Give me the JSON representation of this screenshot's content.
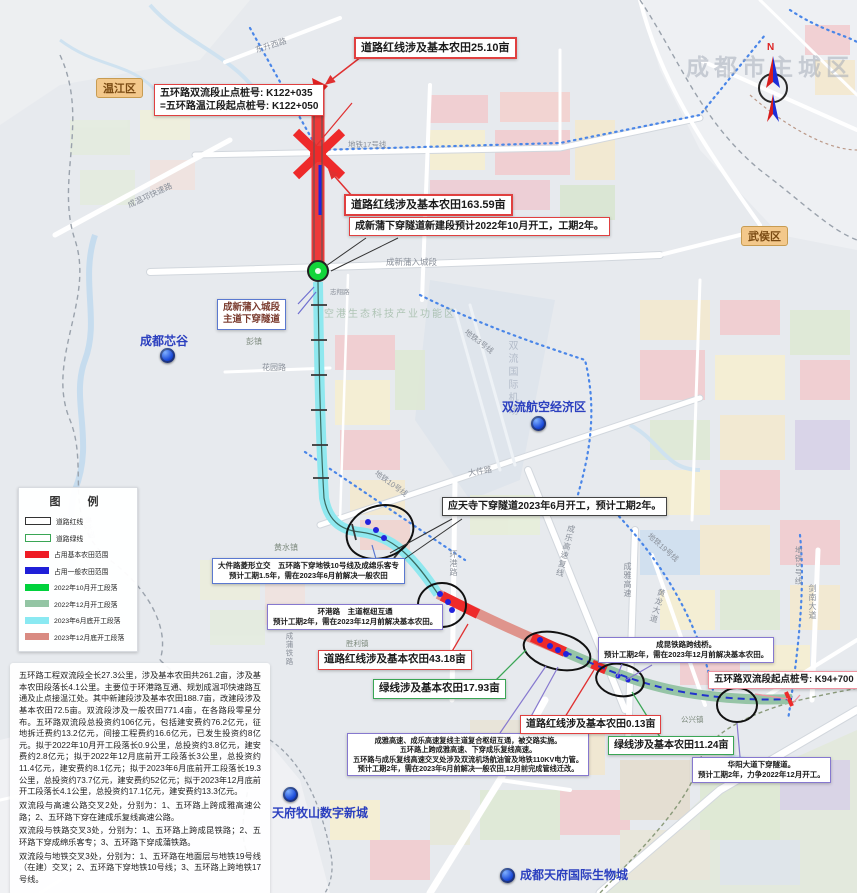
{
  "watermark": "成都市主城区",
  "districts": {
    "wenjiang": "温江区",
    "wuhou": "武侯区"
  },
  "compass": {
    "north": "N"
  },
  "legend": {
    "title": "图　例",
    "items": [
      {
        "label": "道路红线",
        "swatch": "outline-black"
      },
      {
        "label": "道路绿线",
        "swatch": "outline-green"
      },
      {
        "label": "占用基本农田范围",
        "color": "#ee1c25"
      },
      {
        "label": "占用一般农田范围",
        "color": "#1f1fd8"
      },
      {
        "label": "2022年10月开工段落",
        "color": "#00d23c"
      },
      {
        "label": "2022年12月开工段落",
        "color": "#93c5a4"
      },
      {
        "label": "2023年6月底开工段落",
        "color": "#8ae9f2"
      },
      {
        "label": "2023年12月底开工段落",
        "color": "#d98b82"
      }
    ]
  },
  "callouts": {
    "endpoint_stake": {
      "line1": "五环路双流段止点桩号: K122+035",
      "line2": "=五环路温江段起点桩号: K122+050"
    },
    "redline_2510": {
      "text": "道路红线涉及基本农田25.10亩"
    },
    "redline_16359": {
      "text": "道路红线涉及基本农田163.59亩"
    },
    "chengxinpu_tunnel": {
      "text": "成新蒲下穿隧道新建段预计2022年10月开工，工期2年。"
    },
    "chengxinpu_entry": {
      "line1": "成新蒲入城段",
      "line2": "主道下穿隧道"
    },
    "yingtiansi": {
      "text": "应天寺下穿隧道2023年6月开工，预计工期2年。"
    },
    "dajianlu": {
      "line1": "大件路菱形立交　五环路下穿地铁10号线及成绵乐客专",
      "line2": "预计工期1.5年，需在2023年6月前解决一般农田"
    },
    "huanganglu": {
      "line1": "环港路　主道枢纽互通",
      "line2": "预计工期2年，需在2023年12月前解决基本农田。"
    },
    "redline_4318": {
      "text": "道路红线涉及基本农田43.18亩"
    },
    "greenline_1793": {
      "text": "绿线涉及基本农田17.93亩"
    },
    "hub": {
      "line1": "成雅高速、成乐高速复线主道复合枢纽互通，被交路实施。",
      "line2": "五环路上跨成雅高速、下穿成乐复线高速。",
      "line3": "五环路与成乐复线高速交叉处涉及双流机场航油管及地铁110KV电力管。",
      "line4": "预计工期2年，需在2023年6月前解决一般农田,12月前完成管线迁改。"
    },
    "redline_013": {
      "text": "道路红线涉及基本农田0.13亩"
    },
    "greenline_1124": {
      "text": "绿线涉及基本农田11.24亩"
    },
    "chengkun_bridge": {
      "line1": "成昆铁路跨线桥。",
      "line2": "预计工期2年，需在2023年12月前解决基本农田。"
    },
    "start_stake": {
      "text": "五环路双流段起点桩号: K94+700"
    },
    "huayang_tunnel": {
      "line1": "华阳大道下穿隧道。",
      "line2": "预计工期2年，力争2022年12月开工。"
    }
  },
  "labels": {
    "dongsheng_xilu": "东升西路",
    "metro17": "地铁17号线",
    "chengwenqiong": "成温邛快速路",
    "chengxinpu_rd": "成新蒲入城段",
    "zhixiang_rd": "志翔路",
    "pengzhen": "彭镇",
    "huayuan_rd": "花园路",
    "chengdu_xingu": "成都芯谷",
    "konggang": "空港生态科技产业功能区",
    "metro3": "地铁3号线",
    "airport": "双流国际机场",
    "shuangliu_econ": "双流航空经济区",
    "dajian_rd": "大件路",
    "metro10": "地铁10号线",
    "huangshui_river": "黄水河",
    "huangshui_town": "黄水镇",
    "huangang_rd": "环港路",
    "chengle_expwy": "成乐高速复线",
    "metro19": "地铁19号线",
    "chengya_expwy": "成雅高速",
    "huanglong_ave": "黄龙大道",
    "shengli_town": "胜利镇",
    "chengpu_rail": "成蒲铁路",
    "gongxing_town": "公兴镇",
    "metro5": "地铁5号线",
    "jiannan_ave": "剑南大道",
    "mushan": "天府牧山数字新城",
    "bio_city": "成都天府国际生物城"
  },
  "notes": {
    "p1": "五环路工程双流段全长27.3公里，涉及基本农田共261.2亩，涉及基本农田段落长4.1公里。主要位于环港路互通、规划成温邛快速路互通及止点接温江处。其中新建段涉及基本农田188.7亩，改建段涉及基本农田72.5亩。双流段涉及一般农田771.4亩，在各路段零星分布。五环路双流段总投资约106亿元，包括建安费约76.2亿元，征地拆迁费约13.2亿元，间接工程费约16.6亿元，已发生投资约8亿元。拟于2022年10月开工段落长0.9公里，总投资约3.8亿元，建安费约2.8亿元；拟于2022年12月底前开工段落长3公里，总投资约11.4亿元，建安费约8.1亿元；拟于2023年6月底前开工段落长19.3公里，总投资约73.7亿元，建安费约52亿元；拟于2023年12月底前开工段落长4.1公里，总投资约17.1亿元，建安费约13.3亿元。",
    "p2": "双流段与高速公路交叉2处，分别为：1、五环路上跨成雅高速公路；2、五环路下穿在建成乐复线高速公路。",
    "p3": "双流段与铁路交叉3处，分别为：1、五环路上跨成昆铁路；2、五环路下穿成绵乐客专；3、五环路下穿成蒲铁路。",
    "p4": "双流段与地铁交叉3处，分别为：1、五环路在地面层与地铁19号线（在建）交叉；2、五环路下穿地铁10号线；3、五环路上跨地铁17号线。"
  },
  "colors": {
    "farmland_red": "#ee1c25",
    "farmland_blue": "#1f1fd8",
    "seg_green_oct2022": "#00d23c",
    "seg_sage_dec2022": "#93c5a4",
    "seg_cyan_jun2023": "#8ae9f2",
    "seg_salmon_dec2023": "#d98b82"
  }
}
